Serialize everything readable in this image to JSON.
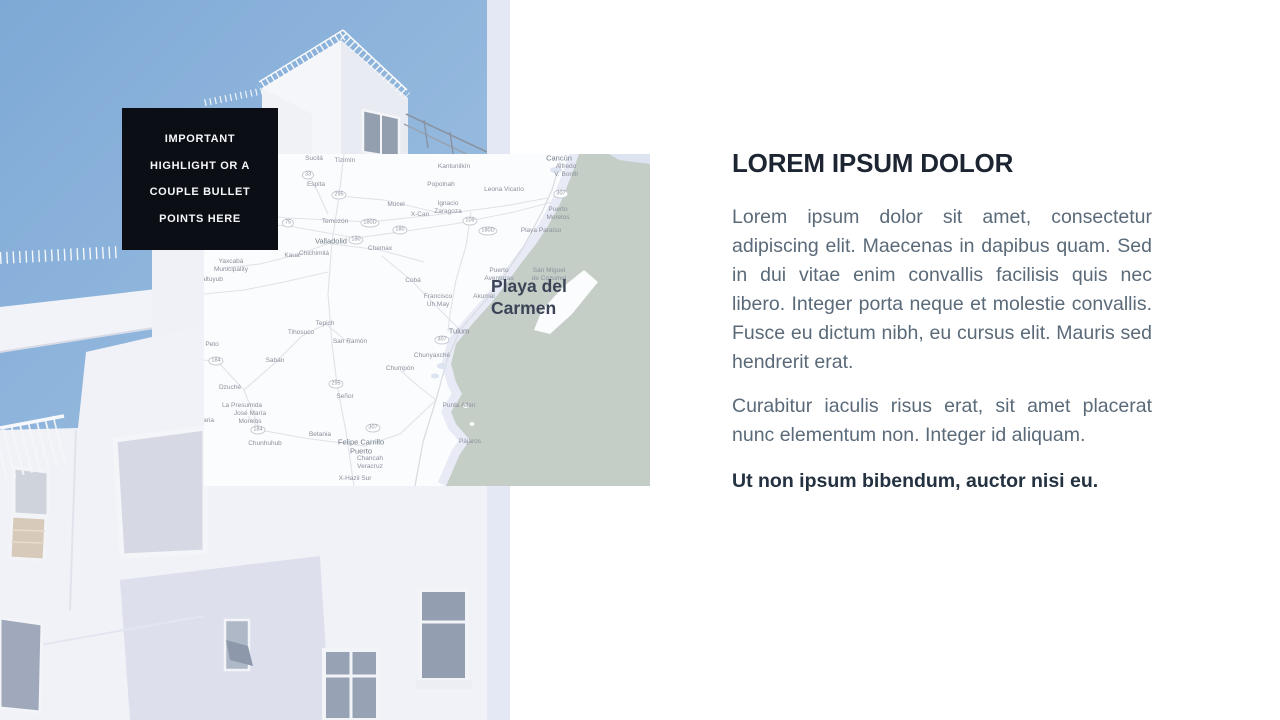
{
  "colors": {
    "box-bg": "#0b0f15",
    "title-color": "#1c2531",
    "body-color": "#5a6a79",
    "sky-top": "#7ea9d6",
    "sky-bottom": "#a6c5e4",
    "sea": "#c4cdc6",
    "star-fill": "#ccd6ee",
    "star-stroke": "#414e66"
  },
  "highlight_box": {
    "lines": [
      "IMPORTANT",
      "HIGHLIGHT OR A",
      "COUPLE BULLET",
      "POINTS HERE"
    ]
  },
  "map": {
    "marker_label": "Playa del Carmen",
    "labels": [
      {
        "t": "Sucilá",
        "x": 110,
        "y": 5
      },
      {
        "t": "Tizimín",
        "x": 141,
        "y": 7
      },
      {
        "t": "Espita",
        "x": 112,
        "y": 31
      },
      {
        "t": "Mucel",
        "x": 192,
        "y": 51
      },
      {
        "t": "X-Can",
        "x": 216,
        "y": 61
      },
      {
        "t": "Temozón",
        "x": 131,
        "y": 68
      },
      {
        "t": "Valladolid",
        "x": 127,
        "y": 87,
        "major": true
      },
      {
        "t": "Chemax",
        "x": 176,
        "y": 95
      },
      {
        "t": "Kaua",
        "x": 88,
        "y": 102
      },
      {
        "t": "Chichimilá",
        "x": 110,
        "y": 100
      },
      {
        "t": "Yaxcabá\nMunicipality",
        "x": 27,
        "y": 112
      },
      {
        "t": "acaltuyub",
        "x": 5,
        "y": 126
      },
      {
        "t": "Cobá",
        "x": 209,
        "y": 127
      },
      {
        "t": "Kantunilkín",
        "x": 250,
        "y": 13
      },
      {
        "t": "Cancún",
        "x": 355,
        "y": 4,
        "major": true
      },
      {
        "t": "Alfredo\nV. Bonfil",
        "x": 362,
        "y": 17
      },
      {
        "t": "Popolnah",
        "x": 237,
        "y": 31
      },
      {
        "t": "Leona Vicario",
        "x": 300,
        "y": 36
      },
      {
        "t": "Ignacio\nZaragoza",
        "x": 244,
        "y": 54
      },
      {
        "t": "Puerto\nMorelos",
        "x": 354,
        "y": 60
      },
      {
        "t": "Playa Paraíso",
        "x": 337,
        "y": 77
      },
      {
        "t": "San Miguel\nde Cozumel",
        "x": 345,
        "y": 121
      },
      {
        "t": "Puerto\nAventuras",
        "x": 295,
        "y": 121
      },
      {
        "t": "Akumal",
        "x": 280,
        "y": 143
      },
      {
        "t": "Francisco\nUh May",
        "x": 234,
        "y": 147
      },
      {
        "t": "Peto",
        "x": 8,
        "y": 191
      },
      {
        "t": "Tepich",
        "x": 121,
        "y": 170
      },
      {
        "t": "Tihosuco",
        "x": 97,
        "y": 179
      },
      {
        "t": "San Ramón",
        "x": 146,
        "y": 188
      },
      {
        "t": "Sabán",
        "x": 71,
        "y": 207
      },
      {
        "t": "Chumpón",
        "x": 196,
        "y": 215
      },
      {
        "t": "Dzuché",
        "x": 26,
        "y": 234
      },
      {
        "t": "Señor",
        "x": 141,
        "y": 243
      },
      {
        "t": "La Presumida",
        "x": 38,
        "y": 252
      },
      {
        "t": "José María\nMorelos",
        "x": 46,
        "y": 264
      },
      {
        "t": "Betania",
        "x": 116,
        "y": 281
      },
      {
        "t": "Chunhuhub",
        "x": 61,
        "y": 290
      },
      {
        "t": "Felipe Carrillo\nPuerto",
        "x": 157,
        "y": 293,
        "major": true
      },
      {
        "t": "Chancah\nVeracruz",
        "x": 166,
        "y": 309
      },
      {
        "t": "X-Hazil Sur",
        "x": 151,
        "y": 325
      },
      {
        "t": "Tulum",
        "x": 255,
        "y": 177,
        "major": true
      },
      {
        "t": "Chunyaxché",
        "x": 228,
        "y": 202
      },
      {
        "t": "Punta Allen",
        "x": 255,
        "y": 252
      },
      {
        "t": "Pájaros",
        "x": 266,
        "y": 288
      },
      {
        "t": "elaria",
        "x": 2,
        "y": 267
      }
    ],
    "shields": [
      {
        "t": "33",
        "x": 104,
        "y": 21
      },
      {
        "t": "295",
        "x": 135,
        "y": 41
      },
      {
        "t": "75",
        "x": 84,
        "y": 69
      },
      {
        "t": "180D",
        "x": 166,
        "y": 69
      },
      {
        "t": "180",
        "x": 196,
        "y": 76
      },
      {
        "t": "180",
        "x": 152,
        "y": 86
      },
      {
        "t": "109",
        "x": 266,
        "y": 67
      },
      {
        "t": "307",
        "x": 357,
        "y": 40
      },
      {
        "t": "180D",
        "x": 284,
        "y": 77
      },
      {
        "t": "184",
        "x": 12,
        "y": 207
      },
      {
        "t": "295",
        "x": 132,
        "y": 230
      },
      {
        "t": "184",
        "x": 54,
        "y": 276
      },
      {
        "t": "307",
        "x": 169,
        "y": 274
      },
      {
        "t": "307",
        "x": 238,
        "y": 186
      }
    ]
  },
  "content": {
    "title": "LOREM IPSUM DOLOR",
    "paragraphs": [
      "Lorem ipsum dolor sit amet, consectetur adipiscing elit. Maecenas in dapibus quam. Sed in dui vitae enim convallis facilisis quis nec libero. Integer porta neque et molestie convallis. Fusce eu dictum nibh, eu cursus elit. Mauris sed hendrerit erat.",
      "Curabitur iaculis risus erat, sit amet placerat nunc elementum non. Integer id aliquam."
    ],
    "emphasis": "Ut non ipsum bibendum, auctor nisi eu."
  }
}
